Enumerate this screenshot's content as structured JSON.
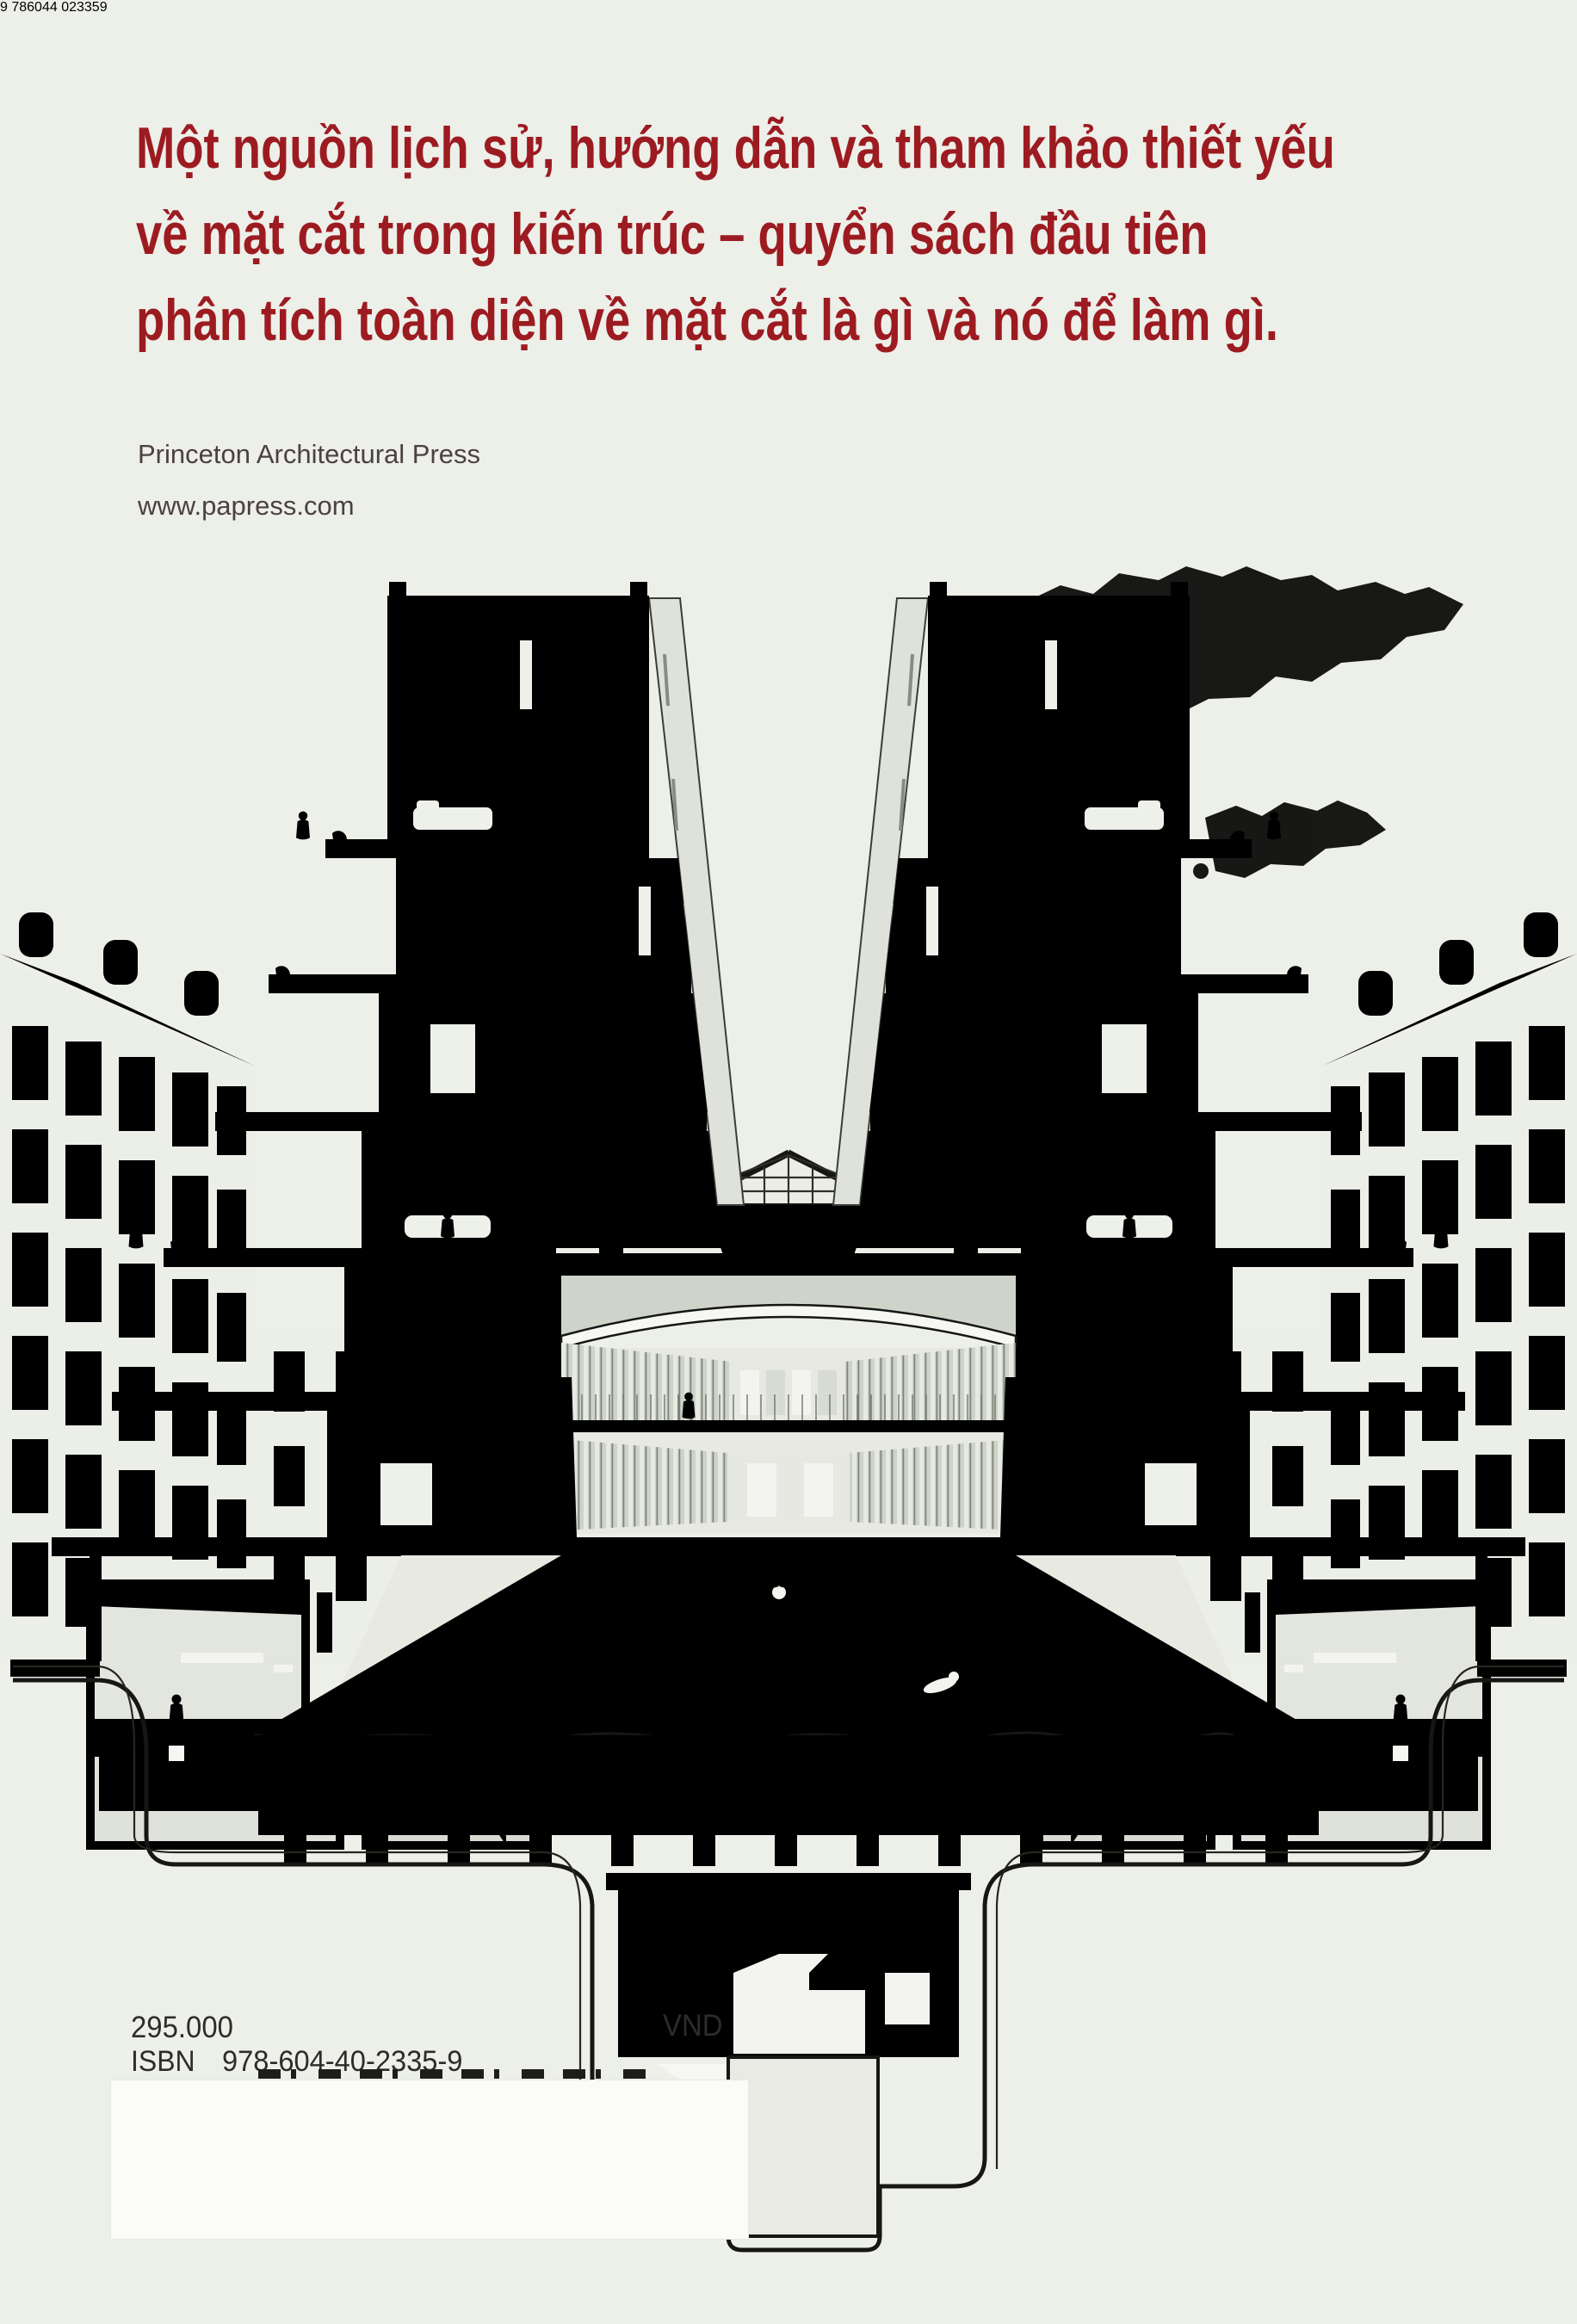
{
  "page": {
    "background": "#edefe9",
    "accent_red": "#9c1b21"
  },
  "tagline": {
    "lines": [
      "Một nguồn lịch sử, hướng dẫn và tham khảo thiết yếu",
      "về mặt cắt trong kiến trúc – quyển sách đầu tiên",
      "phân tích toàn diện về mặt cắt là gì và nó để làm gì."
    ]
  },
  "publisher": {
    "name": "Princeton Architectural Press",
    "website": "www.papress.com"
  },
  "pricing": {
    "price": "295.000",
    "currency": "VND",
    "isbn_label": "ISBN",
    "isbn": "978-604-40-2335-9"
  },
  "barcode": {
    "lead_digit": "9",
    "group1": "786044",
    "group2": "023359",
    "full": "9 786044 023359"
  },
  "illustration": {
    "name": "building-section-perspective",
    "description": "Cut-away perspective section: terraced apartment wings flanking a top-lit swimming hall with pool, changing cubicles, basement plant rooms and pile foundations, with faint city buildings behind"
  },
  "colors": {
    "ink": "#161614",
    "cut_fill": "#f6f7f2",
    "room_fill": "#daddd4",
    "shade_fill": "#c2c7bd",
    "water_fill": "#f2f4ee",
    "faint_line": "#b7bdb3"
  }
}
